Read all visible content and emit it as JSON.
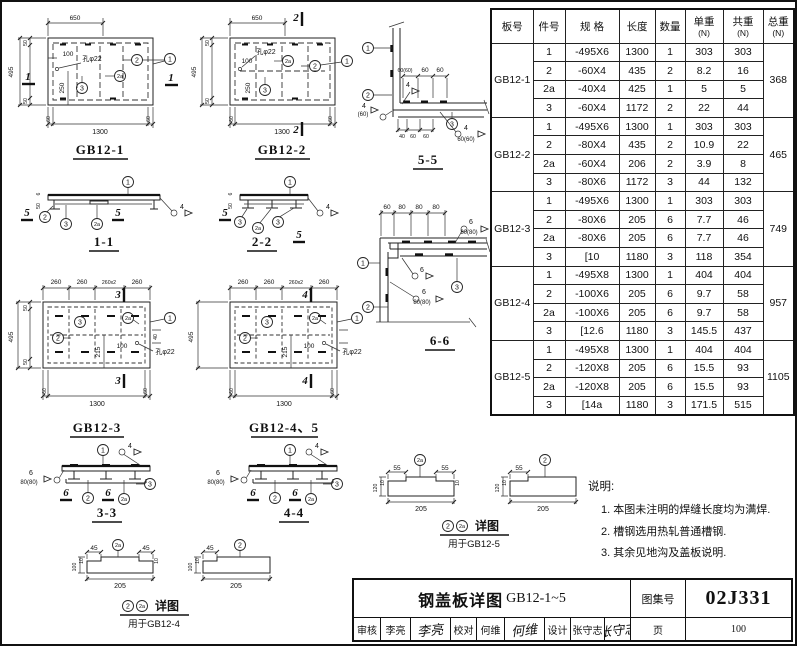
{
  "labels": {
    "d650": "650",
    "d1300": "1300",
    "d495": "495",
    "d250": "250",
    "d100": "100",
    "d60": "60",
    "d50": "50",
    "d40": "40",
    "d80": "80",
    "d6": "6",
    "d260": "260",
    "d260x2": "260x2",
    "d215": "215",
    "d205": "205",
    "d55": "55",
    "d45": "45",
    "d10": "10",
    "d120": "120",
    "hole": "孔φ22",
    "w4": "4",
    "w6": "6",
    "p60": "(60)",
    "p6060": "60(60)",
    "p8080": "80(80)",
    "b1": "1",
    "b2": "2",
    "b2a": "2a",
    "b3": "3",
    "s1": "1",
    "s2": "2",
    "s3": "3",
    "s4": "4",
    "s5": "5",
    "s6": "6"
  },
  "figures": {
    "gb12_1": "GB12-1",
    "gb12_2": "GB12-2",
    "gb12_3": "GB12-3",
    "gb12_45": "GB12-4、5",
    "s11": "1-1",
    "s22": "2-2",
    "s33": "3-3",
    "s44": "4-4",
    "s55": "5-5",
    "s66": "6-6",
    "det_label": "详图",
    "det4_use": "用于GB12-4",
    "det5_use": "用于GB12-5"
  },
  "table": {
    "headers": [
      {
        "t": "板号",
        "u": ""
      },
      {
        "t": "件号",
        "u": ""
      },
      {
        "t": "规 格",
        "u": ""
      },
      {
        "t": "长度",
        "u": ""
      },
      {
        "t": "数量",
        "u": ""
      },
      {
        "t": "单重",
        "u": "(N)"
      },
      {
        "t": "共重",
        "u": "(N)"
      },
      {
        "t": "总重",
        "u": "(N)"
      }
    ],
    "groups": [
      {
        "plate": "GB12-1",
        "total": "368",
        "rows": [
          [
            "1",
            "-495X6",
            "1300",
            "1",
            "303",
            "303"
          ],
          [
            "2",
            "-60X4",
            "435",
            "2",
            "8.2",
            "16"
          ],
          [
            "2a",
            "-40X4",
            "425",
            "1",
            "5",
            "5"
          ],
          [
            "3",
            "-60X4",
            "1172",
            "2",
            "22",
            "44"
          ]
        ]
      },
      {
        "plate": "GB12-2",
        "total": "465",
        "rows": [
          [
            "1",
            "-495X6",
            "1300",
            "1",
            "303",
            "303"
          ],
          [
            "2",
            "-80X4",
            "435",
            "2",
            "10.9",
            "22"
          ],
          [
            "2a",
            "-60X4",
            "206",
            "2",
            "3.9",
            "8"
          ],
          [
            "3",
            "-80X6",
            "1172",
            "3",
            "44",
            "132"
          ]
        ]
      },
      {
        "plate": "GB12-3",
        "total": "749",
        "rows": [
          [
            "1",
            "-495X6",
            "1300",
            "1",
            "303",
            "303"
          ],
          [
            "2",
            "-80X6",
            "205",
            "6",
            "7.7",
            "46"
          ],
          [
            "2a",
            "-80X6",
            "205",
            "6",
            "7.7",
            "46"
          ],
          [
            "3",
            "[10",
            "1180",
            "3",
            "118",
            "354"
          ]
        ]
      },
      {
        "plate": "GB12-4",
        "total": "957",
        "rows": [
          [
            "1",
            "-495X8",
            "1300",
            "1",
            "404",
            "404"
          ],
          [
            "2",
            "-100X6",
            "205",
            "6",
            "9.7",
            "58"
          ],
          [
            "2a",
            "-100X6",
            "205",
            "6",
            "9.7",
            "58"
          ],
          [
            "3",
            "[12.6",
            "1180",
            "3",
            "145.5",
            "437"
          ]
        ]
      },
      {
        "plate": "GB12-5",
        "total": "1105",
        "rows": [
          [
            "1",
            "-495X8",
            "1300",
            "1",
            "404",
            "404"
          ],
          [
            "2",
            "-120X8",
            "205",
            "6",
            "15.5",
            "93"
          ],
          [
            "2a",
            "-120X8",
            "205",
            "6",
            "15.5",
            "93"
          ],
          [
            "3",
            "[14a",
            "1180",
            "3",
            "171.5",
            "515"
          ]
        ]
      }
    ]
  },
  "notes": {
    "title": "说明:",
    "items": [
      "1. 本图未注明的焊缝长度均为满焊.",
      "2. 槽钢选用热轧普通槽钢.",
      "3. 其余见地沟及盖板说明."
    ]
  },
  "titleblock": {
    "title_cn": "钢盖板详图",
    "title_code": "GB12-1~5",
    "atlas_label": "图集号",
    "atlas_no": "02J331",
    "page_label": "页",
    "page_no": "100",
    "roles": [
      {
        "label": "审核",
        "name": "李亮",
        "sig": "李亮"
      },
      {
        "label": "校对",
        "name": "何维",
        "sig": "何维"
      },
      {
        "label": "设计",
        "name": "张守志",
        "sig": "张守志"
      }
    ]
  }
}
